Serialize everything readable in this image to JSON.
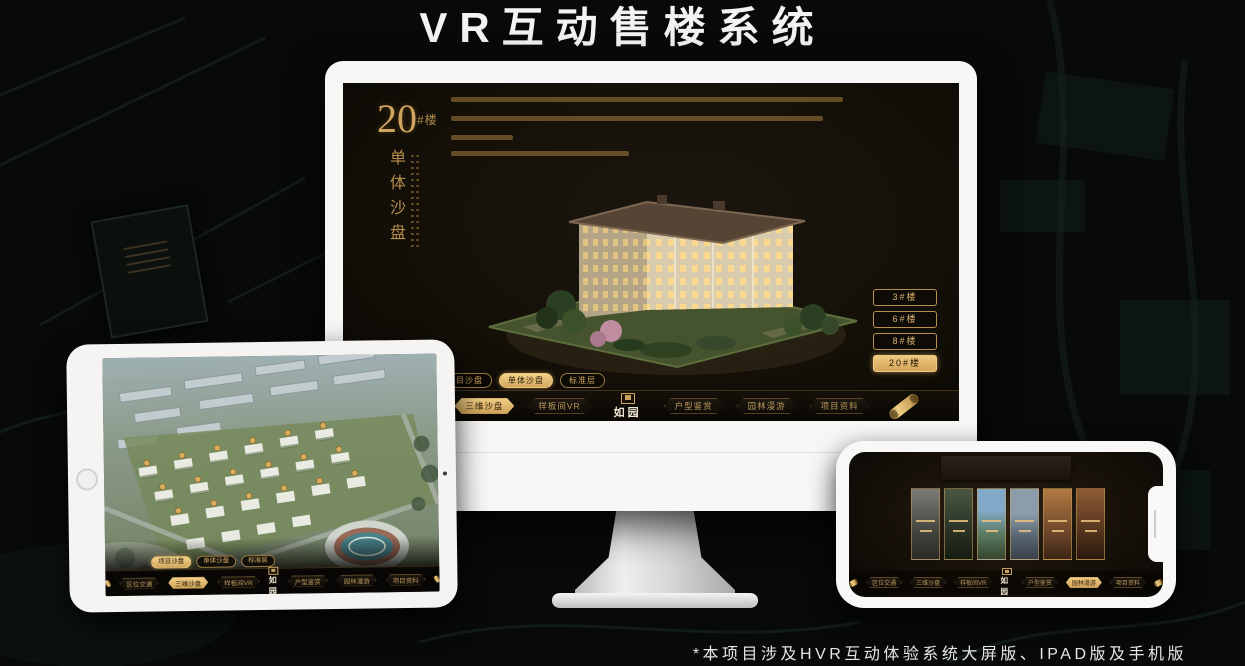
{
  "page": {
    "title": "VR互动售楼系统",
    "footnote": "*本项目涉及HVR互动体验系统大屏版、IPAD版及手机版"
  },
  "nav": {
    "items": [
      "区位交通",
      "三维沙盘",
      "样板间VR",
      "户型鉴赏",
      "园林漫游",
      "项目资料"
    ],
    "logo": "如园"
  },
  "sub_tabs": [
    "项目沙盘",
    "单体沙盘",
    "标准层"
  ],
  "monitor": {
    "heading": {
      "number": "20",
      "unit": "#楼",
      "subtitle": "单体沙盘"
    },
    "floor_buttons": [
      "3#楼",
      "6#楼",
      "8#楼",
      "20#楼"
    ],
    "active": {
      "floor": "20#楼",
      "sub_tab": "单体沙盘",
      "nav": "三维沙盘"
    }
  },
  "ipad": {
    "active": {
      "sub_tab": "项目沙盘",
      "nav": "三维沙盘"
    }
  },
  "phone": {
    "active": {
      "nav": "园林漫游"
    }
  },
  "colors": {
    "gold": "#c79a55",
    "gold_bright": "#e8c27a",
    "screen_bg": "#141008"
  }
}
